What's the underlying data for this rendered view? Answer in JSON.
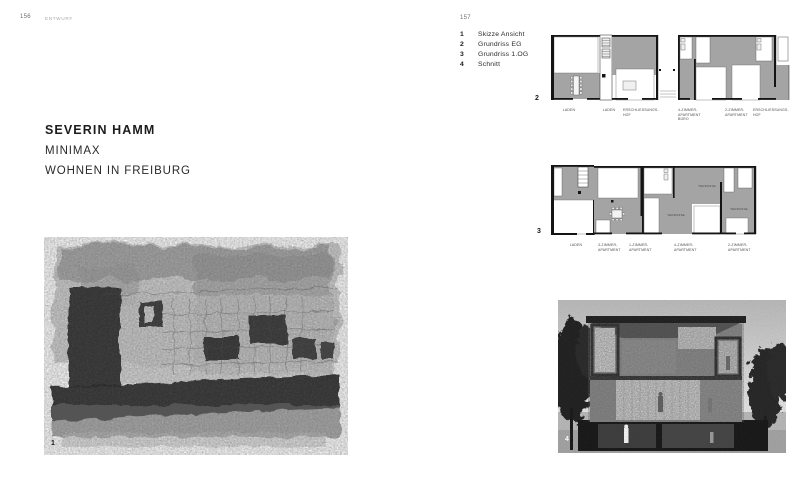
{
  "spread": {
    "left_page": {
      "folio": "156",
      "running_head": "ENTWURF",
      "author": "SEVERIN HAMM",
      "project_title": "MINIMAX",
      "project_subtitle": "WOHNEN IN FREIBURG",
      "sketch_figure_number": "1"
    },
    "right_page": {
      "folio": "157",
      "legend": {
        "items": [
          {
            "num": "1",
            "label": "Skizze Ansicht"
          },
          {
            "num": "2",
            "label": "Grundriss EG"
          },
          {
            "num": "3",
            "label": "Grundriss 1.OG"
          },
          {
            "num": "4",
            "label": "Schnitt"
          }
        ]
      },
      "plan_eg": {
        "figure_number": "2",
        "labels": [
          "LADEN",
          "LADEN",
          "ERSCHLIESSUNGS-\nHOF",
          "4-ZIMMER-\nAPARTMENT\nBÜRO",
          "2-ZIMMER-\nAPARTMENT",
          "ERSCHLIESSUNGS-\nHOF"
        ]
      },
      "plan_og": {
        "figure_number": "3",
        "labels": [
          "LADEN",
          "3-ZIMMER-\nAPARTMENT",
          "1-ZIMMER-\nAPARTMENT",
          "4-ZIMMER-\nAPARTMENT",
          "2-ZIMMER-\nAPARTMENT"
        ],
        "terrasse": [
          "TERRASSE",
          "TERRASSE",
          "TERRASSE"
        ]
      },
      "section_figure_number": "4"
    },
    "colors": {
      "page_bg": "#ffffff",
      "plan_gray": "#a4a4a4",
      "wall_black": "#141414",
      "text_dark": "#1c1c1c",
      "text_muted": "#a8a8a8"
    }
  }
}
